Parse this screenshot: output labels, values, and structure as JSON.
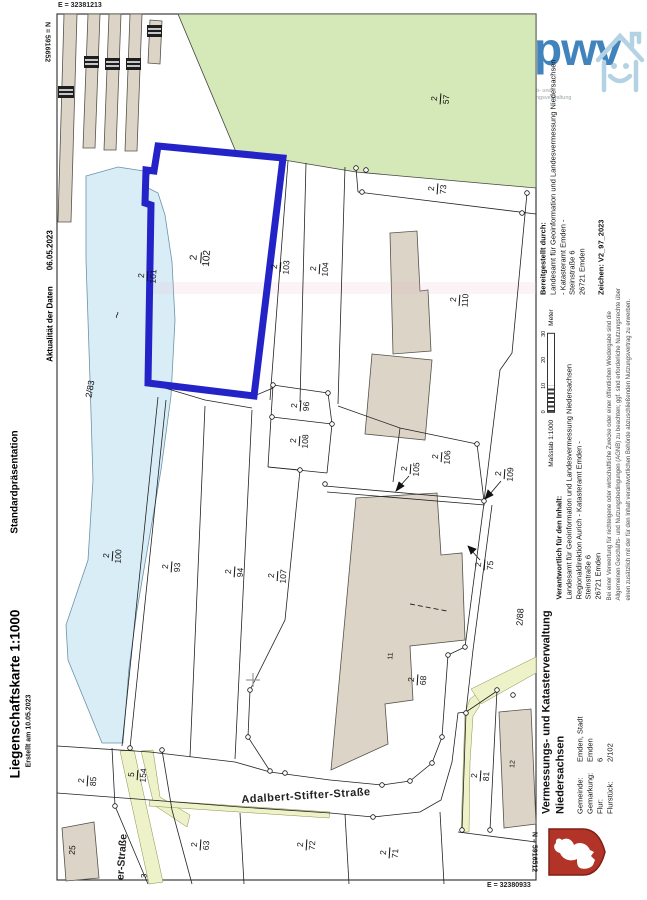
{
  "left_panel": {
    "title": "Liegenschaftskarte 1:1000",
    "created": "Erstellt am 10.05.2023",
    "presentation": "Standardpräsentation",
    "currency_label": "Aktualität der Daten",
    "currency_date": "06.05.2023"
  },
  "frame_coords": {
    "top_e": "E = 32381213",
    "top_n": "N = 5916652",
    "bottom_n": "N = 5916512",
    "bottom_e": "E = 32380933"
  },
  "map": {
    "highlight_color": "#2323c8",
    "water_color": "#d9edf7",
    "green_color": "#d5e8b7",
    "building_color": "#dcd4c6",
    "streets": {
      "main": "Adalbert-Stifter-Straße",
      "side": "er-Straße"
    },
    "parcel_fractions": [
      {
        "num": "2",
        "den": "101"
      },
      {
        "num": "2",
        "den": "102"
      },
      {
        "num": "2",
        "den": "103"
      },
      {
        "num": "2",
        "den": "104"
      },
      {
        "num": "2",
        "den": "57"
      },
      {
        "num": "2",
        "den": "73"
      },
      {
        "num": "2",
        "den": "110"
      },
      {
        "num": "2",
        "den": "96"
      },
      {
        "num": "2",
        "den": "108"
      },
      {
        "num": "2",
        "den": "106"
      },
      {
        "num": "2",
        "den": "105"
      },
      {
        "num": "2",
        "den": "109"
      },
      {
        "num": "2",
        "den": "75"
      },
      {
        "num": "2",
        "den": "100"
      },
      {
        "num": "2",
        "den": "93"
      },
      {
        "num": "2",
        "den": "94"
      },
      {
        "num": "2",
        "den": "107"
      },
      {
        "num": "2",
        "den": "68"
      },
      {
        "num": "2",
        "den": "85"
      },
      {
        "num": "5",
        "den": "154"
      },
      {
        "num": "2",
        "den": "63"
      },
      {
        "num": "2",
        "den": "72"
      },
      {
        "num": "2",
        "den": "71"
      },
      {
        "num": "2",
        "den": "81"
      }
    ],
    "plain_labels": [
      {
        "text": "2/83"
      },
      {
        "text": "2/88"
      },
      {
        "text": "11"
      },
      {
        "text": "12"
      },
      {
        "text": "25"
      },
      {
        "text": "~"
      },
      {
        "text": "3"
      }
    ]
  },
  "right_panel": {
    "logo": {
      "text": "pwv",
      "tagline_1": "b- und",
      "tagline_2": "ngsverwaltung"
    },
    "provided_by": {
      "heading": "Bereitgestellt durch:",
      "line1": "Landesamt für Geoinformation und Landesvermessung Niedersachsen",
      "line2": "- Katasteramt Emden -",
      "line3": "Steinstraße 6",
      "line4": "26721 Emden",
      "ref": "Zeichen:  V2_97_2023"
    },
    "scale": {
      "label": "Maßstab  1:1000",
      "ticks": [
        "0",
        "10",
        "20",
        "30"
      ],
      "unit": "Meter"
    },
    "responsible": {
      "heading": "Verantwortlich für den Inhalt:",
      "line1": "Landesamt für Geoinformation und Landesvermessung Niedersachsen",
      "line2": "Regionaldirektion Aurich - Katasteramt Emden -",
      "line3": "Steinstraße 6",
      "line4": "26721 Emden"
    },
    "disclaimer": {
      "line1": "Bei einer Verwertung für nichteigene oder wirtschaftliche Zwecke oder einer öffentlichen Wiedergabe sind die",
      "line2": "Allgemeinen Geschäfts- und Nutzungsbedingungen (AGNB) zu beachten; ggf. sind erforderliche Nutzungsrechte über",
      "line3": "einen zusätzlich mit der für den Inhalt verantwortlichen Behörde abzuschließenden Nutzungsvertrag zu erwerben."
    },
    "authority": {
      "name1": "Vermessungs- und Katasterverwaltung",
      "name2": "Niedersachsen",
      "fields": [
        {
          "label": "Gemeinde:",
          "value": "Emden, Stadt"
        },
        {
          "label": "Gemarkung:",
          "value": "Emden"
        },
        {
          "label": "Flur:",
          "value": "6"
        },
        {
          "label": "Flurstück:",
          "value": "2/102"
        }
      ]
    }
  }
}
